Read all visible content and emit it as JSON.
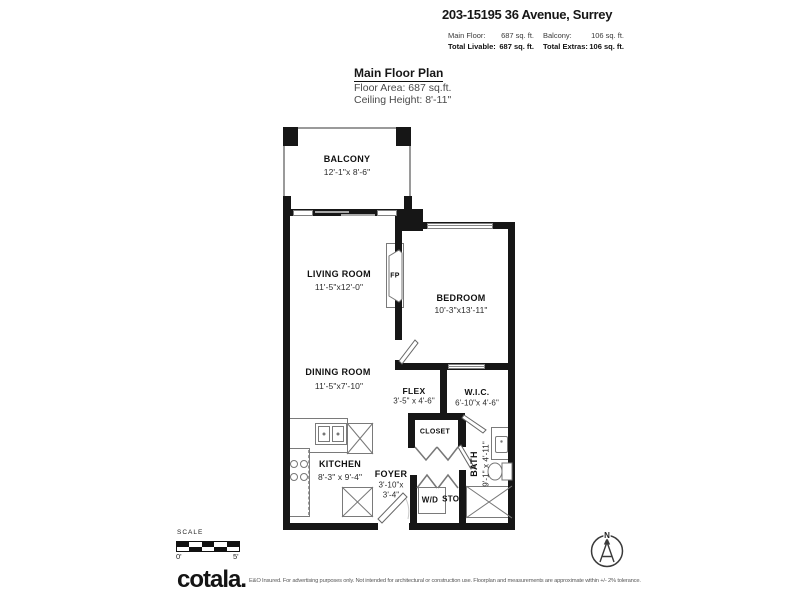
{
  "header": {
    "address": "203-15195 36 Avenue, Surrey",
    "stats": {
      "main_floor_label": "Main Floor:",
      "main_floor_value": "687 sq. ft.",
      "balcony_label": "Balcony:",
      "balcony_value": "106 sq. ft.",
      "total_livable_label": "Total Livable:",
      "total_livable_value": "687 sq. ft.",
      "total_extras_label": "Total Extras:",
      "total_extras_value": "106 sq. ft."
    }
  },
  "plan_title": {
    "title": "Main Floor Plan",
    "floor_area": "Floor Area: 687 sq.ft.",
    "ceiling_height": "Ceiling Height: 8'-11\""
  },
  "rooms": {
    "balcony": {
      "name": "BALCONY",
      "dims": "12'-1\"x 8'-6\""
    },
    "living": {
      "name": "LIVING ROOM",
      "dims": "11'-5\"x12'-0\""
    },
    "bedroom": {
      "name": "BEDROOM",
      "dims": "10'-3\"x13'-11\""
    },
    "dining": {
      "name": "DINING ROOM",
      "dims": "11'-5\"x7'-10\""
    },
    "flex": {
      "name": "FLEX",
      "dims": "3'-5\" x 4'-6\""
    },
    "wic": {
      "name": "W.I.C.",
      "dims": "6'-10\"x 4'-6\""
    },
    "closet": {
      "name": "CLOSET"
    },
    "kitchen": {
      "name": "KITCHEN",
      "dims": "8'-3\" x 9'-4\""
    },
    "foyer": {
      "name": "FOYER",
      "dims_line1": "3'-10\"x",
      "dims_line2": "3'-4\""
    },
    "bath": {
      "name": "BATH",
      "dims": "9'-1\" x 4'-11\""
    },
    "wd": {
      "name": "W/D"
    },
    "sto": {
      "name": "STO."
    },
    "fireplace": {
      "name": "FP"
    }
  },
  "scale": {
    "label": "SCALE",
    "start": "0'",
    "end": "5'"
  },
  "compass": {
    "north_label": "N"
  },
  "footer": {
    "brand": "cotala.",
    "disclaimer": "E&O Insured. For advertising purposes only. Not intended for architectural or construction use. Floorplan and measurements are approximate within +/- 2% tolerance."
  },
  "colors": {
    "wall": "#161616",
    "fixture_line": "#7a7a7a",
    "background": "#ffffff"
  }
}
